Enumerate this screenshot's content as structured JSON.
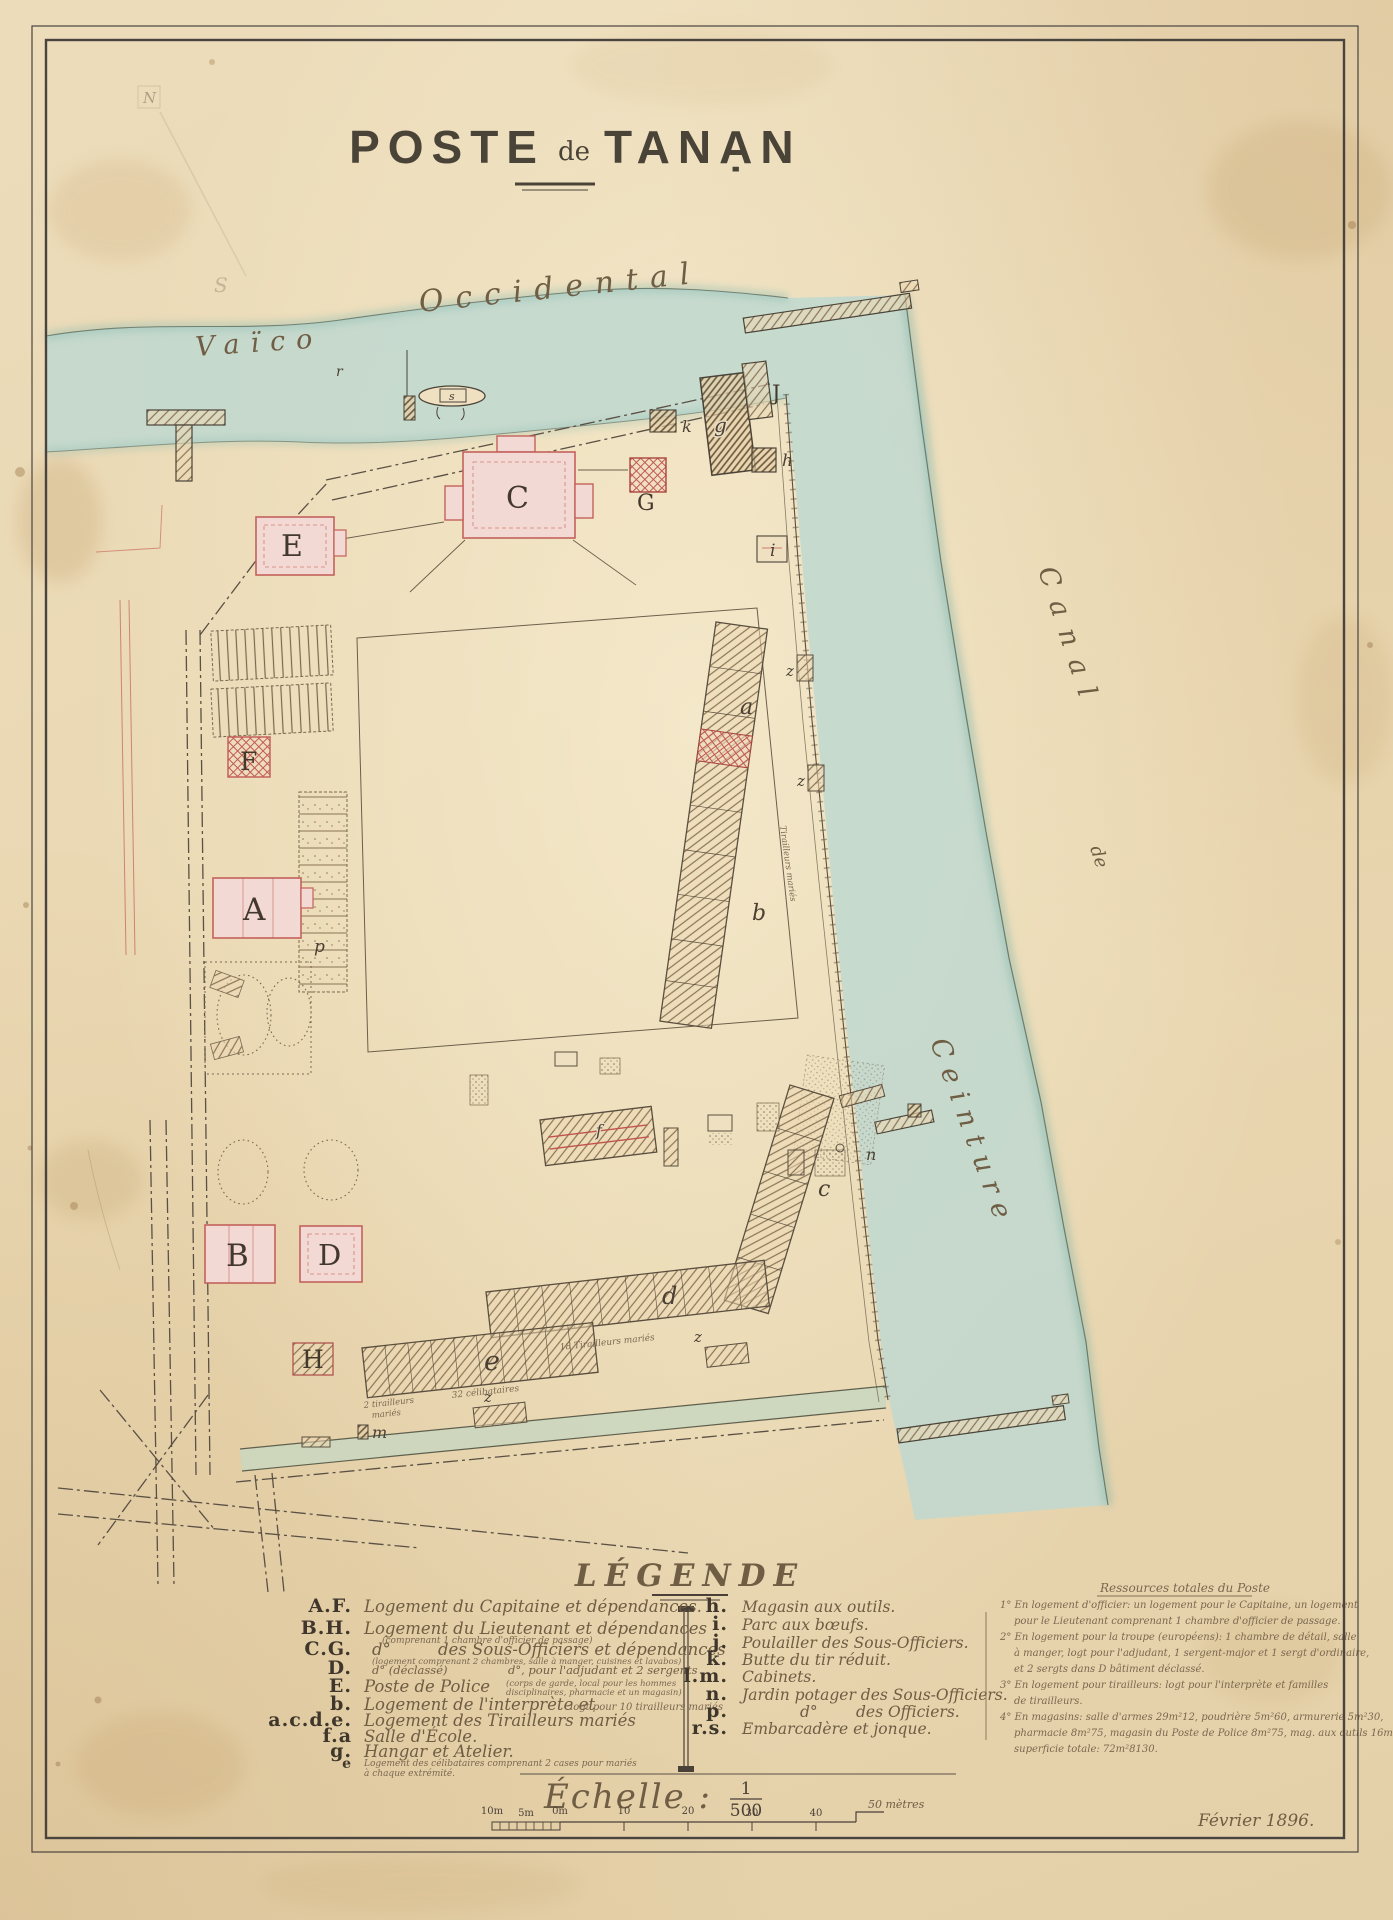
{
  "title": {
    "part1": "POSTE",
    "part2": "de",
    "part3": "TANẠN"
  },
  "water_labels": {
    "vaico": "Vaïco",
    "occidental": "Occidental",
    "canal": "Canal",
    "de": "de",
    "ceinture": "Ceinture"
  },
  "map_labels": {
    "A": "A",
    "B": "B",
    "C": "C",
    "D": "D",
    "E": "E",
    "F": "F",
    "G": "G",
    "H": "H",
    "J": "J",
    "a": "a",
    "b": "b",
    "c": "c",
    "d": "d",
    "e": "e",
    "f": "f",
    "g": "g",
    "h": "h",
    "i": "i",
    "k": "k",
    "m": "m",
    "n": "n",
    "p": "p",
    "r": "r",
    "s": "s",
    "z": "z",
    "north": "N",
    "pencil_s": "S"
  },
  "map_texts": {
    "celibataires": "32 célibataires",
    "tirailleurs2a": "2 tirailleurs",
    "tirailleurs2b": "mariés",
    "tirailleurs18": "18 Tirailleurs mariés",
    "tirailleursV": "Tirailleurs mariés"
  },
  "legend": {
    "title": "LÉGENDE",
    "left": [
      {
        "key": "A.F.",
        "text": "Logement du Capitaine et dépendances."
      },
      {
        "key": "B.H.",
        "text": "Logement du Lieutenant et dépendances",
        "note": "(comprenant 1 chambre d'officier de passage)"
      },
      {
        "key": "C.G.",
        "text": "d°",
        "text2": "des Sous-Officiers et dépendances",
        "note": "(logement comprenant 2 chambres, salle à manger, cuisines et lavabos)"
      },
      {
        "key": "D.",
        "text": "d° (déclassé)",
        "text2": "d°, pour l'adjudant et 2 sergents"
      },
      {
        "key": "E.",
        "text": "Poste de Police",
        "note": "(corps de garde, local pour les hommes",
        "note2": "disciplinaires, pharmacie et un magasin)"
      },
      {
        "key": "b.",
        "text": "Logement de l'interprète et",
        "note": "logt pour 10 tirailleurs mariés"
      },
      {
        "key": "a.c.d.e.",
        "text": "Logement des Tirailleurs mariés"
      },
      {
        "key": "f.a",
        "text": "Salle d'École."
      },
      {
        "key": "g.",
        "text": "Hangar et Atelier."
      },
      {
        "key": "e",
        "note": "Logement des célibataires comprenant 2 cases pour mariés",
        "note2": "à chaque extrémité."
      }
    ],
    "right": [
      {
        "key": "h.",
        "text": "Magasin aux outils."
      },
      {
        "key": "i.",
        "text": "Parc aux bœufs."
      },
      {
        "key": "j.",
        "text": "Poulailler des Sous-Officiers."
      },
      {
        "key": "k.",
        "text": "Butte du tir réduit."
      },
      {
        "key": "l.m.",
        "text": "Cabinets."
      },
      {
        "key": "n.",
        "text": "Jardin potager des Sous-Officiers."
      },
      {
        "key": "p.",
        "text": "d°",
        "text2": "des Officiers."
      },
      {
        "key": "r.s.",
        "text": "Embarcadère et jonque."
      }
    ],
    "notes": {
      "title": "Ressources totales du Poste",
      "lines": [
        "1° En logement d'officier: un logement pour le Capitaine, un logement",
        "pour le Lieutenant comprenant 1 chambre d'officier de passage.",
        "2° En logement pour la troupe (européens): 1 chambre de détail, salle",
        "à manger, logt pour l'adjudant, 1 sergent-major et 1 sergt d'ordinaire,",
        "et 2 sergts dans D bâtiment déclassé.",
        "3° En logement pour tirailleurs: logt pour l'interprète et familles",
        "de tirailleurs.",
        "4° En magasins: salle d'armes 29m²12, poudrière 5m²60, armurerie 5m²30,",
        "pharmacie 8m²75, magasin du Poste de Police 8m²75, mag. aux outils 16m²,",
        "superficie totale: 72m²8130."
      ]
    }
  },
  "scale": {
    "label": "Échelle :",
    "numerator": "1",
    "denominator": "500",
    "tick_labels": [
      "10m",
      "5m",
      "0m",
      "10",
      "20",
      "30",
      "40",
      "50 mètres"
    ]
  },
  "date": "Février 1896.",
  "colors": {
    "water": "#bfd8d0",
    "channel": "#cbd7bf",
    "building_pink": "#f3d9d3",
    "accent_red": "#c0544c",
    "ink": "#4a4438"
  }
}
